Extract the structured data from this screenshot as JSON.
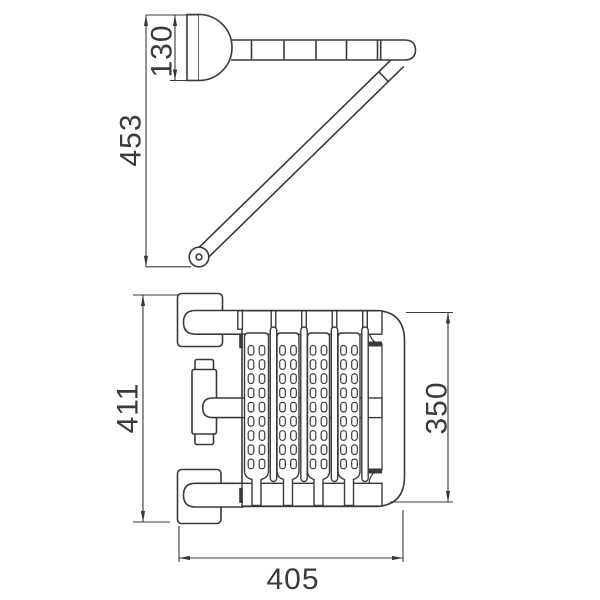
{
  "drawing": {
    "type": "technical-orthographic-drawing",
    "views": {
      "side_view": "wall mount with segmented horizontal bar, diagonal support strut and pivot",
      "plan_view": "perforated slatted rack frame with two wall brackets and center post"
    },
    "dimensions": {
      "mount_height": "130",
      "side_view_height": "453",
      "plan_view_height": "411",
      "frame_depth": "350",
      "frame_width": "405"
    },
    "line_color": "#3a3a3a",
    "background_color": "#ffffff"
  }
}
